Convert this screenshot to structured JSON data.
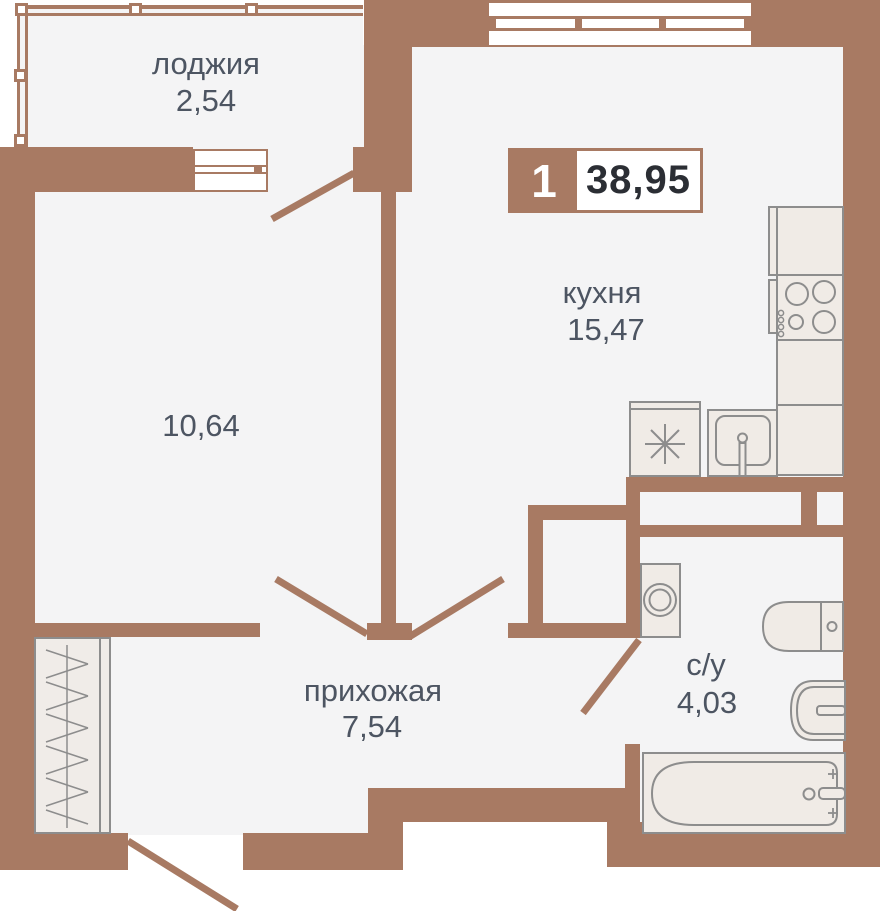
{
  "badge": {
    "rooms_count": "1",
    "total_area": "38,95"
  },
  "rooms": {
    "loggia": {
      "label": "лоджия",
      "area": "2,54"
    },
    "living_room": {
      "area": "10,64"
    },
    "kitchen": {
      "label": "кухня",
      "area": "15,47"
    },
    "hallway": {
      "label": "прихожая",
      "area": "7,54"
    },
    "bathroom": {
      "label": "с/у",
      "area": "4,03"
    }
  },
  "fixtures": [
    "fridge",
    "stove",
    "kitchen-counter",
    "kitchen-sink",
    "freezer",
    "washing-machine",
    "toilet",
    "bathroom-sink",
    "bathtub",
    "wardrobe"
  ],
  "colors": {
    "wall": "#a87a63",
    "floor": "#f4f4f5",
    "fixture_fill": "#f0ebe6",
    "fixture_stroke": "#8d8d8d",
    "label_text": "#4d5562",
    "badge_area_text": "#2b2e34",
    "badge_number_text": "#ffffff"
  }
}
